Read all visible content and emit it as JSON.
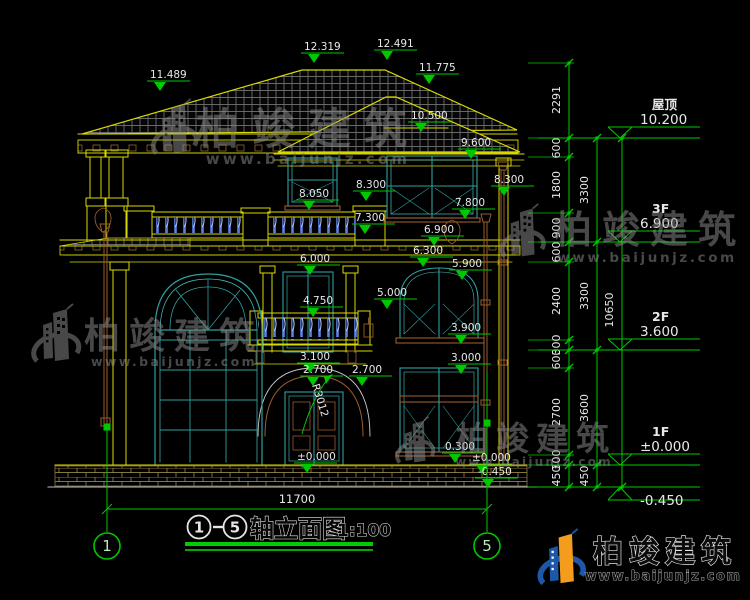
{
  "canvas": {
    "width": 750,
    "height": 600,
    "background": "#000000"
  },
  "colors": {
    "green": "#00c800",
    "yellow": "#d9d900",
    "text": "#e8e8e8",
    "teal": "#2f9e9e",
    "cyan": "#49c0c0",
    "brown": "#9a5b2d",
    "blue": "#5c82e6",
    "watermark": "#8f8f8f",
    "logo_blue": "#1c57a8",
    "logo_orange": "#f49c1c"
  },
  "title_block": {
    "title": "轴立面图",
    "scale": "1:100"
  },
  "axes": {
    "start": "1",
    "end": "5"
  },
  "bottom_dimension": "11700",
  "floor_levels": [
    {
      "name": "屋顶",
      "elev": "10.200",
      "y": 138
    },
    {
      "name": "3F",
      "elev": "6.900",
      "y": 242
    },
    {
      "name": "2F",
      "elev": "3.600",
      "y": 350
    },
    {
      "name": "1F",
      "elev": "±0.000",
      "y": 465
    },
    {
      "name": "",
      "elev": "-0.450",
      "y": 487,
      "below": true
    }
  ],
  "elevation_markers": [
    {
      "label": "11.489",
      "x": 150,
      "y": 78
    },
    {
      "label": "12.319",
      "x": 304,
      "y": 50
    },
    {
      "label": "12.491",
      "x": 377,
      "y": 47
    },
    {
      "label": "11.775",
      "x": 419,
      "y": 71
    },
    {
      "label": "10.500",
      "x": 411,
      "y": 119
    },
    {
      "label": "9.600",
      "x": 461,
      "y": 146
    },
    {
      "label": "8.050",
      "x": 299,
      "y": 197
    },
    {
      "label": "8.300",
      "x": 356,
      "y": 188
    },
    {
      "label": "8.300",
      "x": 494,
      "y": 183
    },
    {
      "label": "7.800",
      "x": 455,
      "y": 206
    },
    {
      "label": "7.300",
      "x": 355,
      "y": 221
    },
    {
      "label": "6.900",
      "x": 424,
      "y": 233
    },
    {
      "label": "6.300",
      "x": 413,
      "y": 254
    },
    {
      "label": "6.000",
      "x": 300,
      "y": 262
    },
    {
      "label": "5.900",
      "x": 452,
      "y": 267
    },
    {
      "label": "5.000",
      "x": 377,
      "y": 296
    },
    {
      "label": "4.750",
      "x": 303,
      "y": 304
    },
    {
      "label": "3.900",
      "x": 451,
      "y": 331
    },
    {
      "label": "3.100",
      "x": 300,
      "y": 360
    },
    {
      "label": "2.700",
      "x": 303,
      "y": 373
    },
    {
      "label": "2.700",
      "x": 352,
      "y": 373
    },
    {
      "label": "3.000",
      "x": 451,
      "y": 361
    },
    {
      "label": "0.300",
      "x": 445,
      "y": 450
    },
    {
      "label": "±0.000",
      "x": 297,
      "y": 460
    },
    {
      "label": "±0.000",
      "x": 472,
      "y": 461
    },
    {
      "label": "-0.450",
      "x": 478,
      "y": 475
    }
  ],
  "radius_label": "R3012",
  "dim_chains": [
    {
      "x": 569,
      "label_x": 560,
      "y1": 63,
      "y2": 487,
      "ext_x1": 528,
      "ext_x2": 574,
      "ticks": [
        63,
        138,
        157,
        213,
        242,
        262,
        340,
        350,
        368,
        455,
        465,
        487
      ],
      "labels": [
        {
          "v": "2291",
          "y": 100
        },
        {
          "v": "600",
          "y": 148
        },
        {
          "v": "1800",
          "y": 185
        },
        {
          "v": "900",
          "y": 228
        },
        {
          "v": "600",
          "y": 252
        },
        {
          "v": "2400",
          "y": 301
        },
        {
          "v": "300",
          "y": 345
        },
        {
          "v": "600",
          "y": 359
        },
        {
          "v": "2700",
          "y": 412
        },
        {
          "v": "300",
          "y": 460
        },
        {
          "v": "450",
          "y": 476
        }
      ]
    },
    {
      "x": 597,
      "label_x": 588,
      "y1": 138,
      "y2": 487,
      "ext_x1": 574,
      "ext_x2": 601,
      "ticks": [
        138,
        242,
        350,
        465,
        487
      ],
      "labels": [
        {
          "v": "3300",
          "y": 190
        },
        {
          "v": "3300",
          "y": 296
        },
        {
          "v": "3600",
          "y": 408
        },
        {
          "v": "450",
          "y": 476
        }
      ]
    },
    {
      "x": 622,
      "label_x": 613,
      "y1": 138,
      "y2": 487,
      "ext_x1": 601,
      "ext_x2": 626,
      "ticks": [
        138,
        487
      ],
      "labels": [
        {
          "v": "10650",
          "y": 310
        }
      ]
    }
  ],
  "watermark": {
    "brand": "柏竣建筑",
    "site": "www.baijunjz.com"
  }
}
